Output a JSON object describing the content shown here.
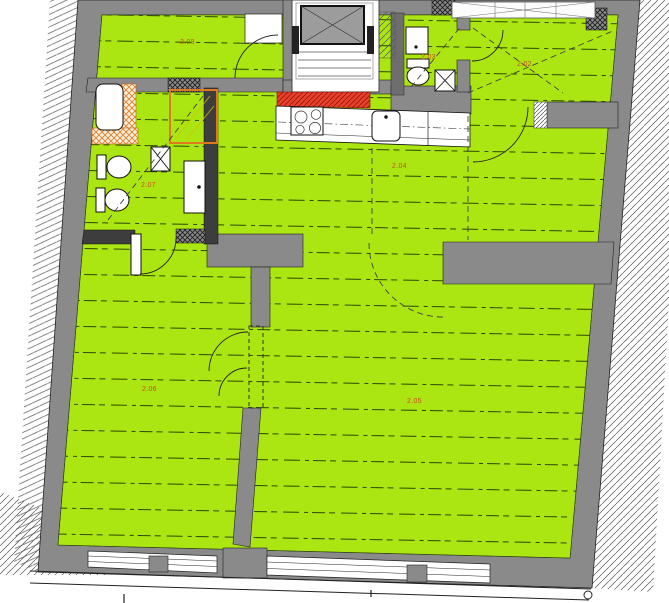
{
  "drawing": {
    "type": "apartment-floor-plan",
    "floor_prefix": "2",
    "rooms": [
      {
        "id": "room-2-08",
        "label": "2.08",
        "x": 180,
        "y": 44
      },
      {
        "id": "room-2-07",
        "label": "2.07",
        "x": 141,
        "y": 187
      },
      {
        "id": "room-2-03",
        "label": "2.03",
        "x": 421,
        "y": 59
      },
      {
        "id": "room-2-02",
        "label": "2.02",
        "x": 517,
        "y": 66
      },
      {
        "id": "room-2-04",
        "label": "2.04",
        "x": 392,
        "y": 168
      },
      {
        "id": "room-2-06",
        "label": "2.06",
        "x": 142,
        "y": 391
      },
      {
        "id": "room-2-05",
        "label": "2.05",
        "x": 407,
        "y": 403
      }
    ],
    "fixtures": [
      "elevator",
      "staircase",
      "bathtub",
      "toilet",
      "toilet",
      "washbasin",
      "ventilation-shaft",
      "stove",
      "kitchen-sink",
      "wc-washbasin",
      "wc-toilet",
      "ventilation-shaft",
      "window",
      "window",
      "sidewalk-line"
    ],
    "colors": {
      "floor_green": "#abe512",
      "wall_gray": "#8a8a8a",
      "wall_dark": "#3d3d3d",
      "accent_red": "#e8402a",
      "accent_orange": "#df7f2e",
      "label_red": "#cc4b1e"
    }
  }
}
